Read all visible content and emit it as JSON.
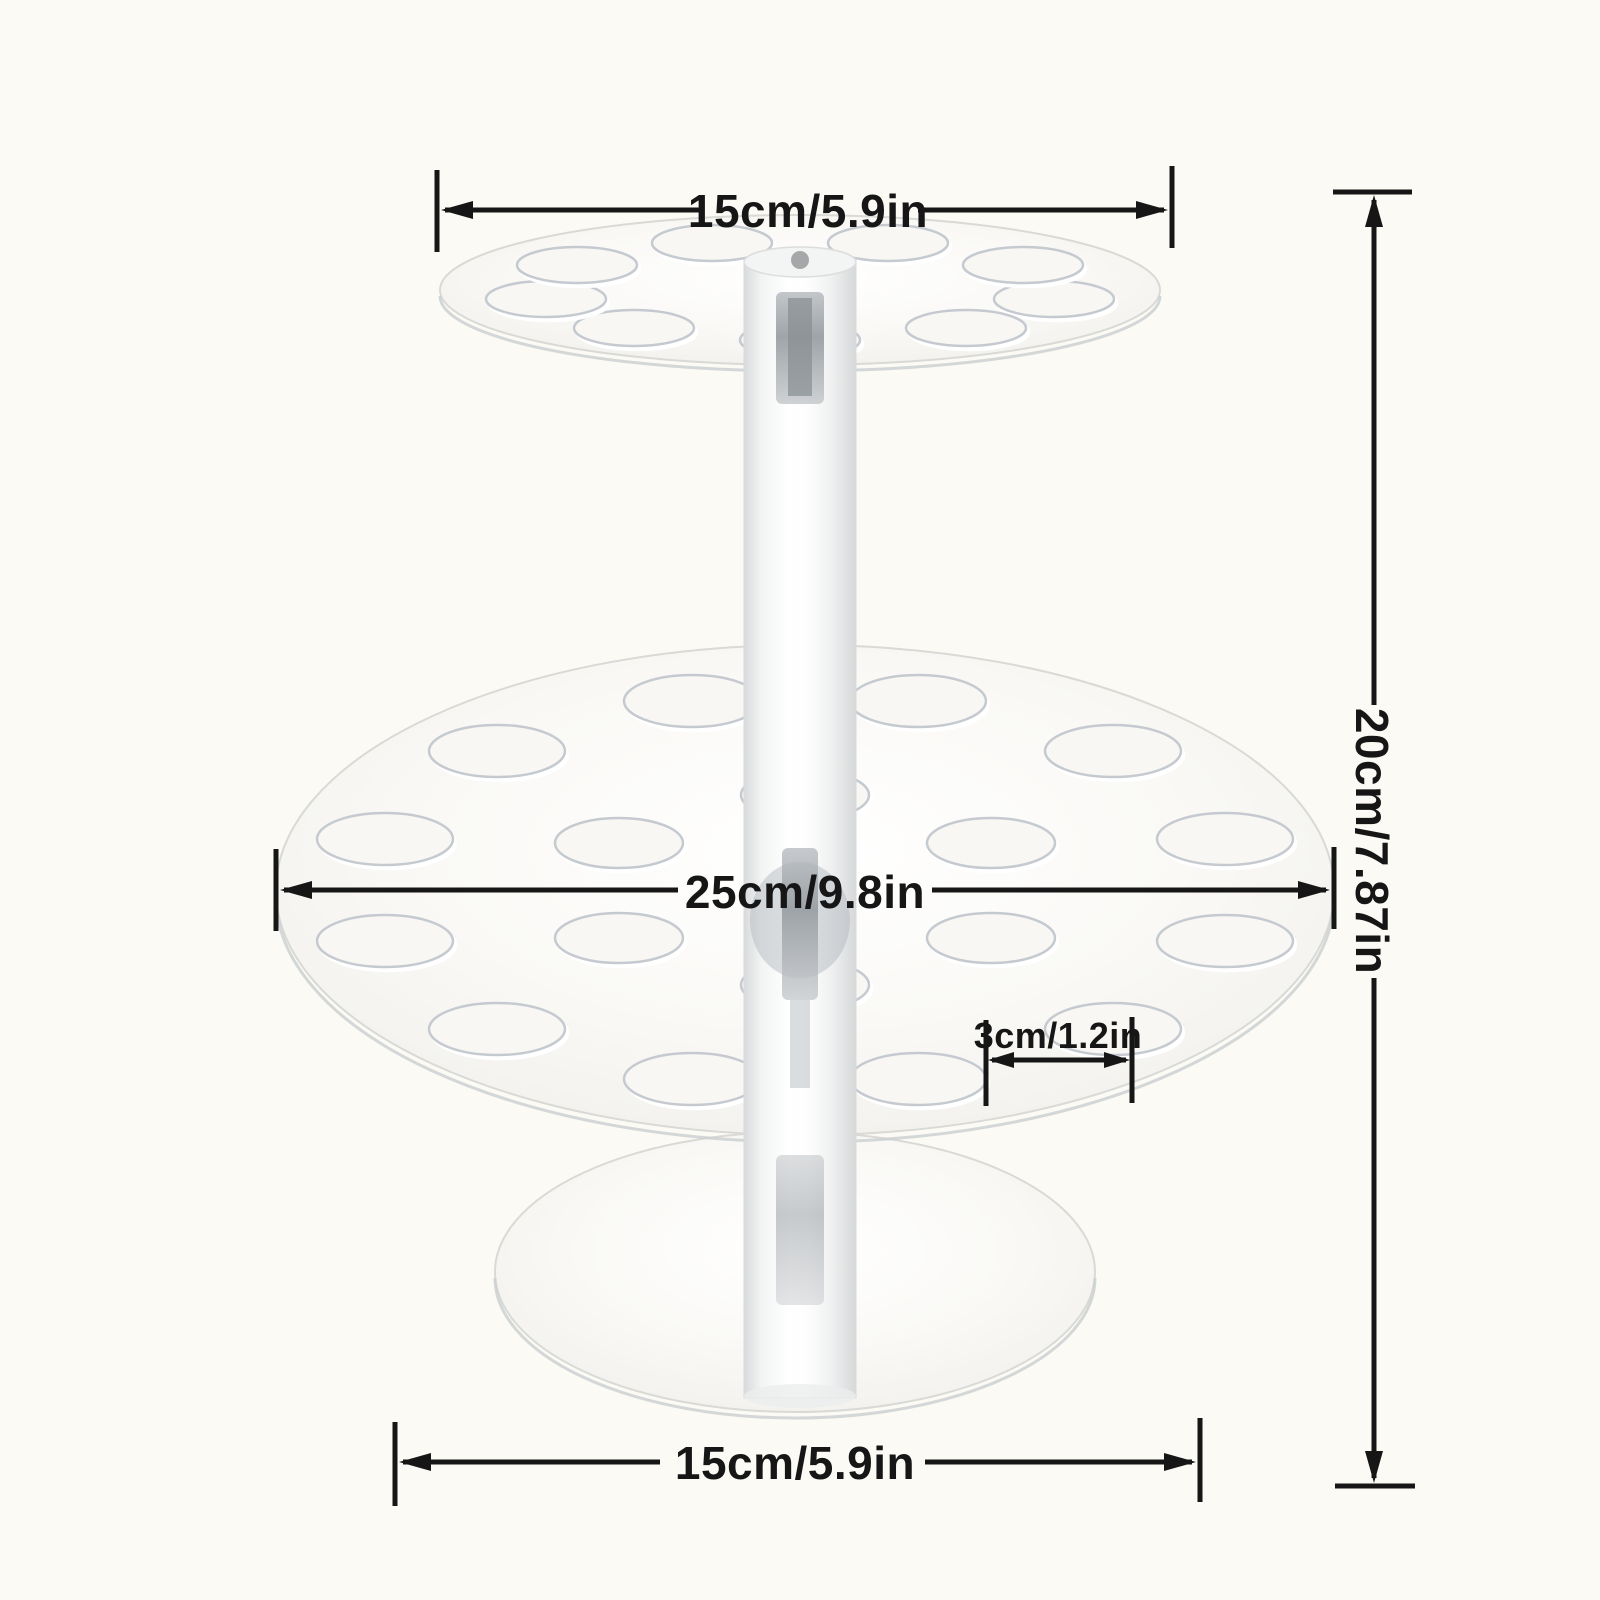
{
  "diagram": {
    "background_color": "#fbfaf4",
    "line_color": "#161616",
    "labels": {
      "top_diameter": "15cm/5.9in",
      "middle_diameter": "25cm/9.8in",
      "hole_diameter": "3cm/1.2in",
      "total_height": "20cm/7.87in",
      "base_diameter": "15cm/5.9in"
    }
  }
}
